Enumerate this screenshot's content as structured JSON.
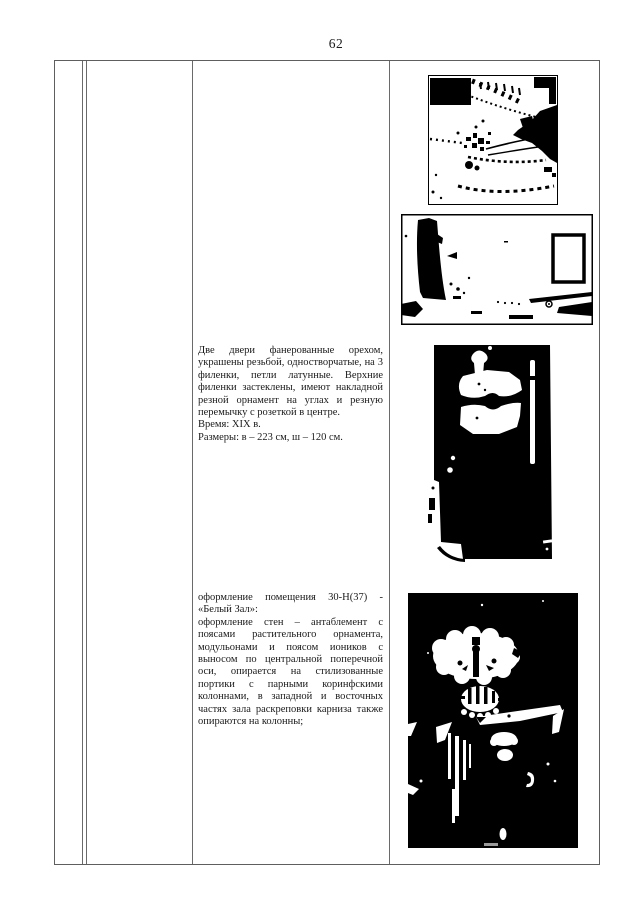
{
  "page": {
    "number": "62"
  },
  "entries": [
    {
      "description": "Две двери фанерованные орехом, украшены резьбой, одностворчатые, на 3 филенки, петли латунные. Верхние филенки застеклены, имеют накладной резной орнамент на углах и резную перемычку с розеткой в центре.",
      "time": "Время: XIX в.",
      "size": "Размеры: в – 223 см, ш – 120 см."
    },
    {
      "title": "оформление помещения 30-Н(37) - «Белый Зал»:",
      "body": "оформление стен – антаблемент с поясами растительного орнамента, модульонами и поясом иоников с выносом по центральной поперечной оси, опирается на стилизованные портики с парными коринфскими колоннами, в западной и восточных частях зала раскреповки карниза также опираются на колонны;"
    }
  ],
  "figures": [
    {
      "name": "cornice-dentil-fragment-photo"
    },
    {
      "name": "hall-wall-with-frame-photo"
    },
    {
      "name": "carved-walnut-door-photo"
    },
    {
      "name": "white-hall-plafond-photo"
    }
  ],
  "colors": {
    "paper": "#ffffff",
    "ink": "#1a1a1a",
    "table_border": "#6a6a6a",
    "photo_black": "#000000"
  }
}
